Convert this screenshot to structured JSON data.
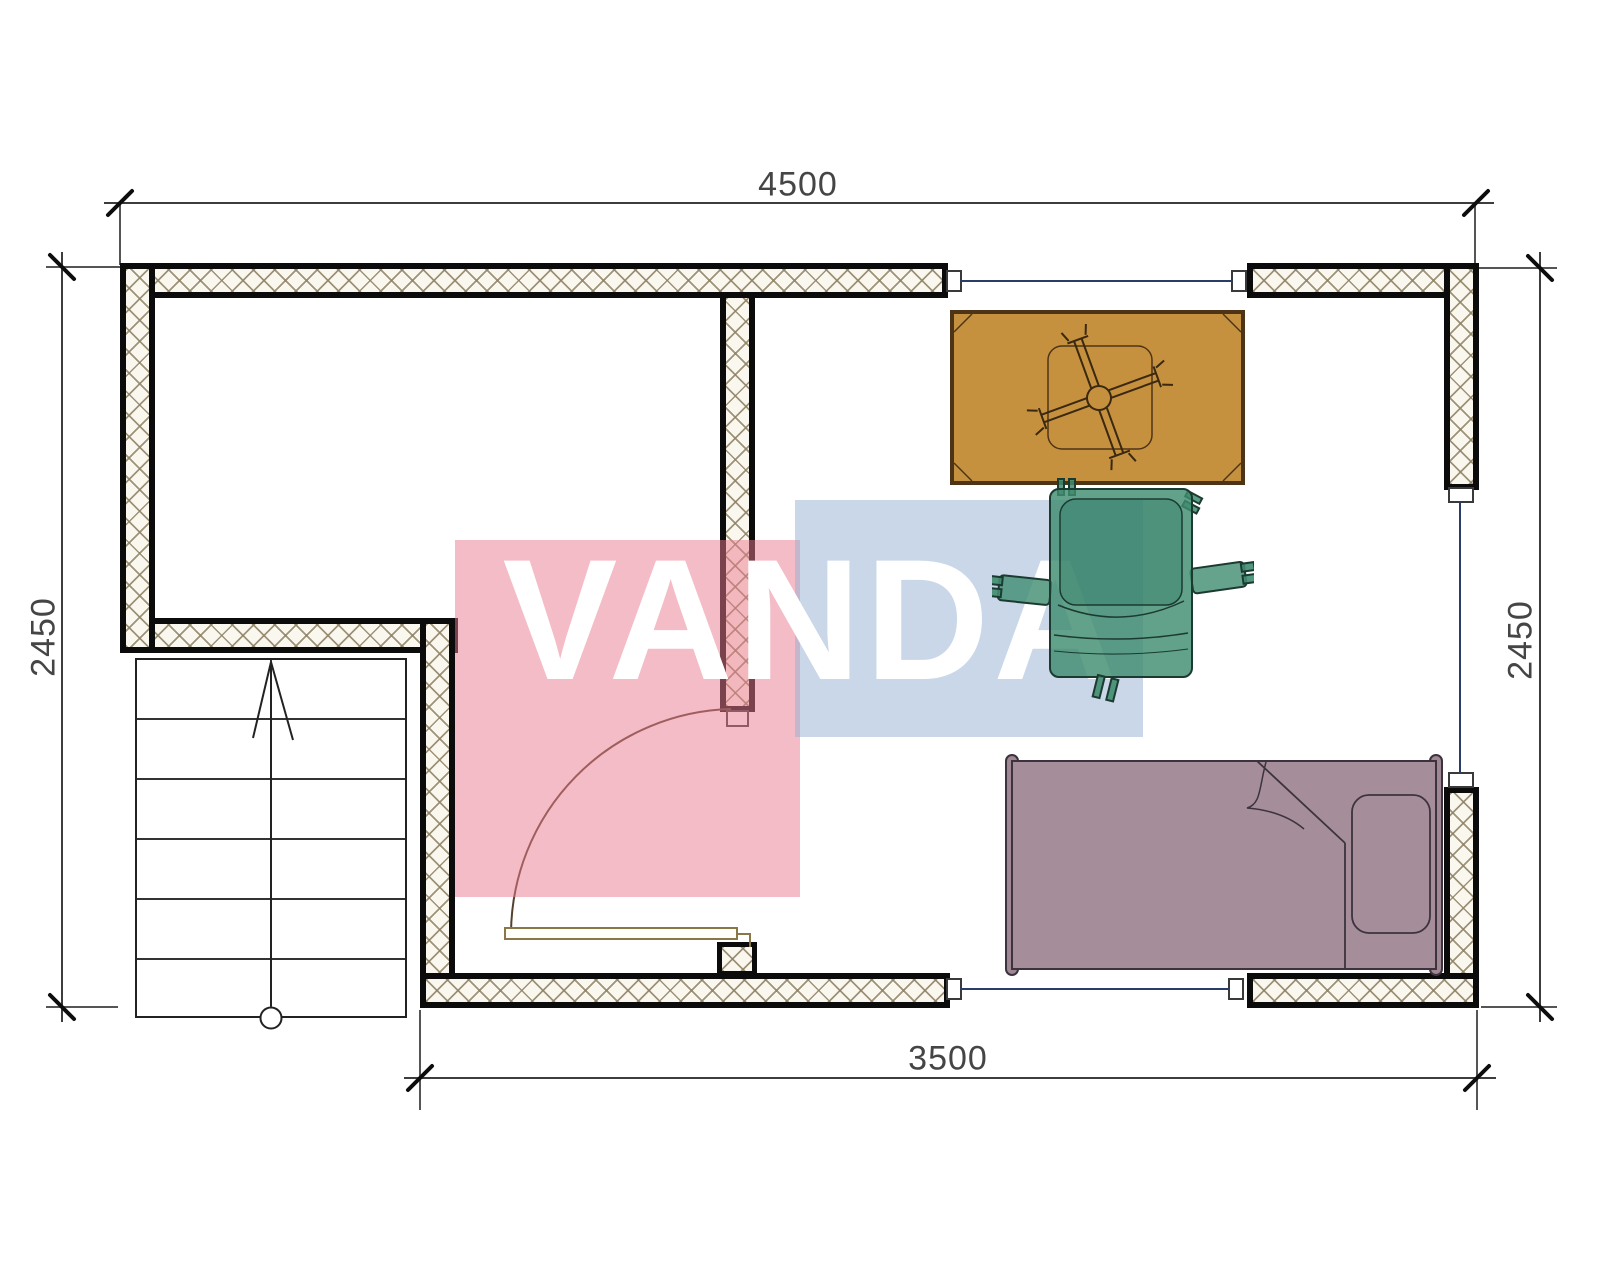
{
  "watermark": {
    "text": "VANDA",
    "text_color": "#ffffff",
    "red_block_color": "#f3b7c2",
    "blue_block_color": "#cbd9e9"
  },
  "dimensions": {
    "top": {
      "value": "4500",
      "orientation": "horizontal"
    },
    "bottom": {
      "value": "3500",
      "orientation": "horizontal"
    },
    "left": {
      "value": "2450",
      "orientation": "vertical"
    },
    "right": {
      "value": "2450",
      "orientation": "vertical"
    }
  },
  "floor_plan": {
    "walls": {
      "fill": "#faf7ef",
      "hatch_line_color": "#8d8163",
      "outline_color": "#0b0b0b",
      "hatch_style": "crosshatch"
    },
    "window_line_color": "#2b3c66",
    "staircase": {
      "treads": 6,
      "direction_arrow": "up"
    },
    "door": {
      "type": "single-swing",
      "swing": "quarter-arc"
    },
    "furniture": [
      {
        "name": "table",
        "color": "#c6913f"
      },
      {
        "name": "armchair",
        "color": "#4f9480"
      },
      {
        "name": "bed",
        "color": "#a58e9a"
      }
    ]
  }
}
